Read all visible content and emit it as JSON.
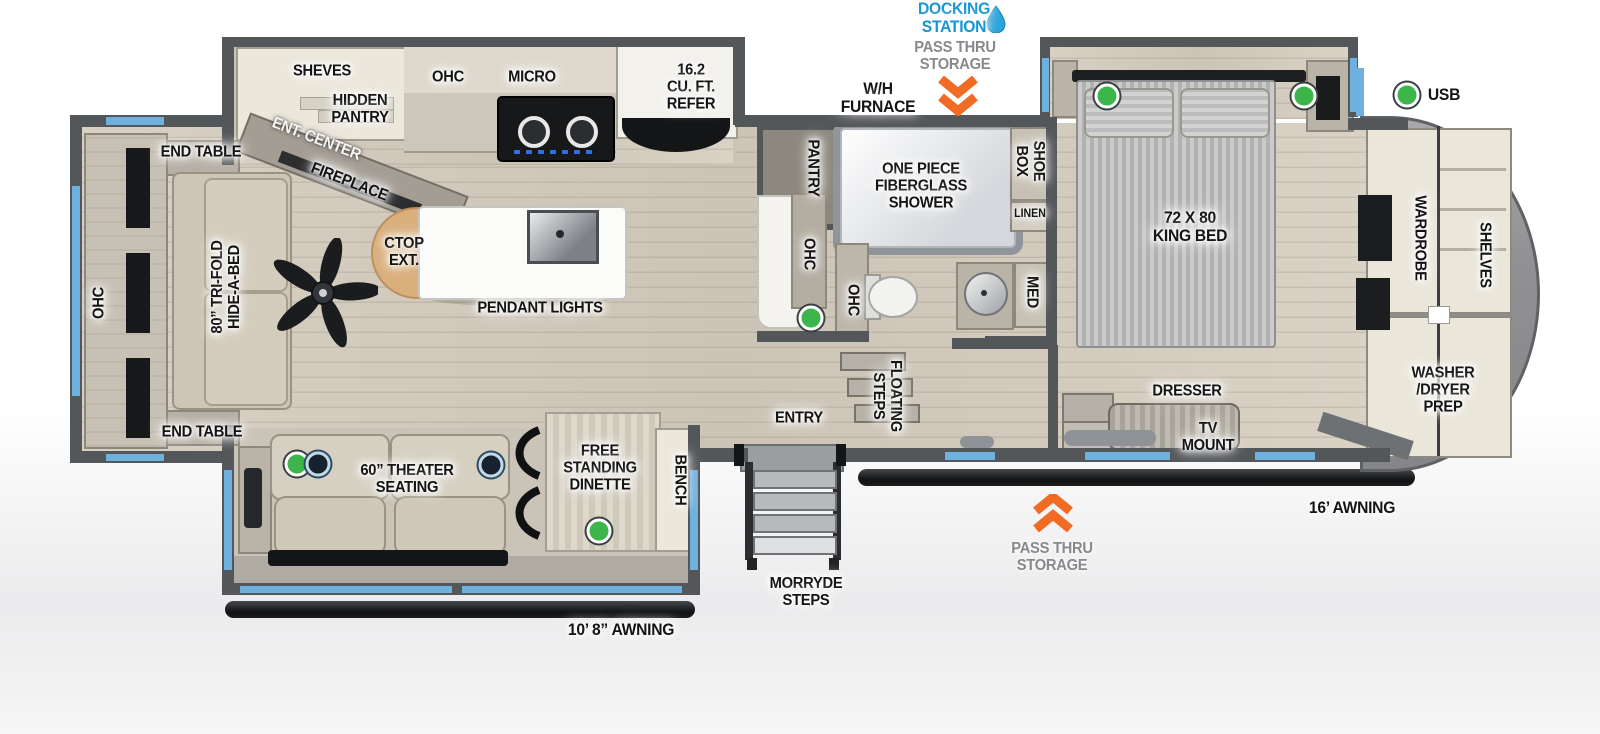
{
  "colors": {
    "accent_blue": "#1496d2",
    "window_blue": "#6fb1de",
    "arrow_orange": "#f26b24",
    "led_green": "#3cb54a",
    "wall_gray": "#54575a"
  },
  "legend": {
    "usb": "USB"
  },
  "exterior": {
    "docking_station": "DOCKING\nSTATION",
    "pass_thru_top": "PASS THRU\nSTORAGE",
    "pass_thru_bottom": "PASS THRU\nSTORAGE",
    "wh_furnace": "W/H\nFURNACE",
    "morryde_steps": "MORRYDE\nSTEPS",
    "awning_front": "16’ AWNING",
    "awning_rear": "10’ 8” AWNING"
  },
  "living": {
    "end_table_top": "END TABLE",
    "end_table_bottom": "END TABLE",
    "ohc": "OHC",
    "hide_a_bed": "80” TRI-FOLD\nHIDE-A-BED",
    "shelves": "SHEVES",
    "hidden_pantry": "HIDDEN\nPANTRY",
    "ent_center": "ENT. CENTER",
    "fireplace": "FIREPLACE",
    "theater_seating": "60” THEATER\nSEATING",
    "dinette": "FREE\nSTANDING\nDINETTE",
    "bench": "BENCH"
  },
  "kitchen": {
    "ohc": "OHC",
    "micro": "MICRO",
    "refrigerator": "16.2\nCU. FT.\nREFER",
    "ctop_ext": "CTOP\nEXT.",
    "pendant_lights": "PENDANT LIGHTS",
    "pantry": "PANTRY",
    "ohc_counter": "OHC"
  },
  "bathroom": {
    "shower": "ONE PIECE\nFIBERGLASS\nSHOWER",
    "shoe_box": "SHOE\nBOX",
    "linen": "LINEN",
    "ohc": "OHC",
    "med": "MED"
  },
  "hallway": {
    "entry": "ENTRY",
    "floating_steps": "FLOATING\nSTEPS"
  },
  "bedroom": {
    "king_bed": "72 X 80\nKING BED",
    "dresser": "DRESSER",
    "tv_mount": "TV\nMOUNT"
  },
  "front_closet": {
    "wardrobe": "WARDROBE",
    "shelves": "SHELVES",
    "washer_dryer_prep": "WASHER\n/DRYER\nPREP"
  }
}
